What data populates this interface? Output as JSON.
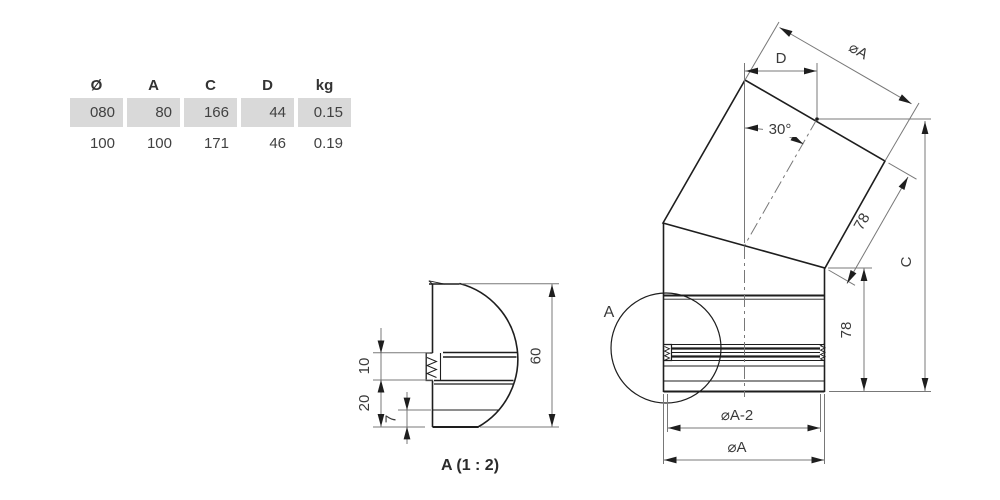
{
  "table": {
    "headers": [
      "Ø",
      "A",
      "C",
      "D",
      "kg"
    ],
    "rows": [
      [
        "080",
        "80",
        "166",
        "44",
        "0.15"
      ],
      [
        "100",
        "100",
        "171",
        "46",
        "0.19"
      ]
    ]
  },
  "main_view": {
    "labels": {
      "dim_d": "D",
      "dim_dia_a_top": "⌀A",
      "dim_angle": "30°",
      "dim_len_upper": "78",
      "dim_len_lower": "78",
      "dim_c": "C",
      "dim_dia_a_minus_2": "⌀A-2",
      "dim_dia_a_bottom": "⌀A",
      "detail_marker": "A"
    }
  },
  "detail_view": {
    "labels": {
      "dim_10": "10",
      "dim_20": "20",
      "dim_7": "7",
      "dim_60": "60"
    },
    "caption": "A (1 : 2)"
  },
  "colors": {
    "background": "#ffffff",
    "part_line": "#1e1e1e",
    "dimension_line": "#787878",
    "text": "#3a3a3a",
    "table_row_shade": "#d9d9d9"
  }
}
